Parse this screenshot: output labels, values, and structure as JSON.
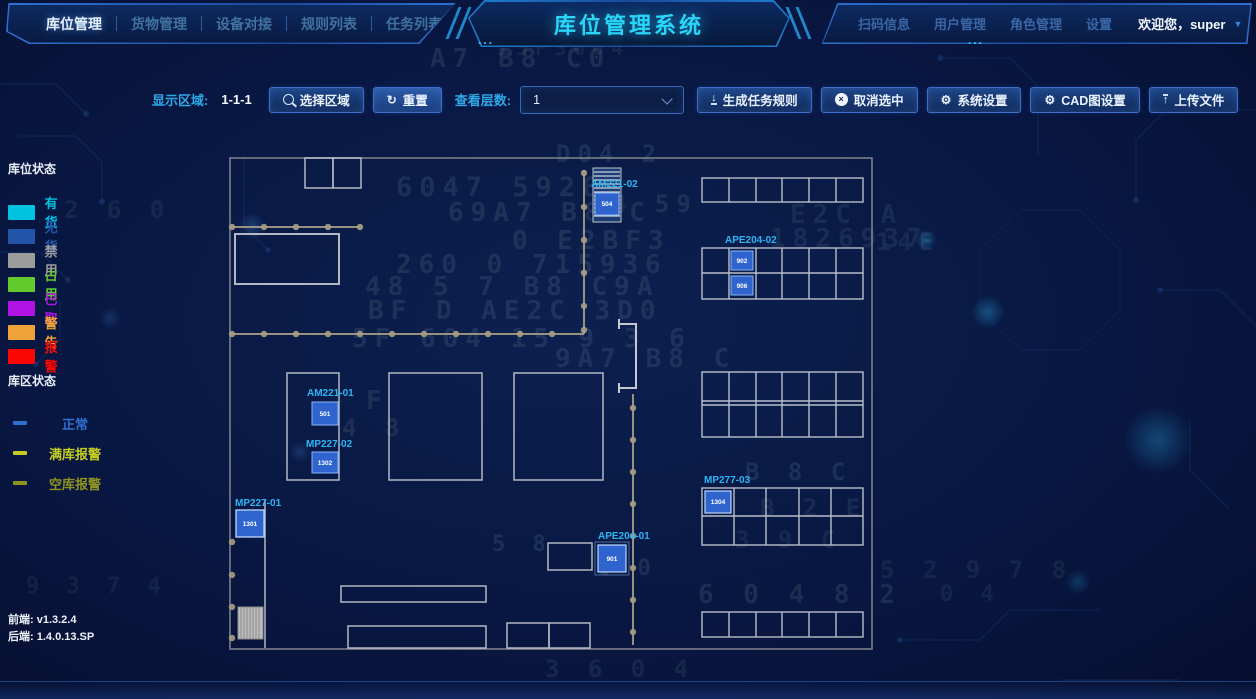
{
  "header": {
    "title": "库位管理系统",
    "dots": "...",
    "left_nav": [
      {
        "label": "库位管理"
      },
      {
        "label": "货物管理"
      },
      {
        "label": "设备对接"
      },
      {
        "label": "规则列表"
      },
      {
        "label": "任务列表"
      }
    ],
    "right_nav": [
      {
        "label": "扫码信息"
      },
      {
        "label": "用户管理"
      },
      {
        "label": "角色管理"
      },
      {
        "label": "设置"
      }
    ],
    "welcome": "欢迎您，super"
  },
  "toolbar": {
    "display_area_label": "显示区域:",
    "display_area_value": "1-1-1",
    "select_area_button": "选择区域",
    "reset_button": "重置",
    "view_layers_label": "查看层数:",
    "view_layers_value": "1",
    "generate_task_rule_button": "生成任务规则",
    "cancel_selection_button": "取消选中",
    "system_settings_button": "系统设置",
    "cad_settings_button": "CAD图设置",
    "upload_file_button": "上传文件"
  },
  "legend": {
    "slot_status_title": "库位状态",
    "slot_statuses": [
      {
        "label": "有货",
        "color": "#00c3e0"
      },
      {
        "label": "无货",
        "color": "#2255a8"
      },
      {
        "label": "禁用",
        "color": "#9c9c9c"
      },
      {
        "label": "占用",
        "color": "#63ca2d"
      },
      {
        "label": "已取",
        "color": "#b013e4"
      },
      {
        "label": "警告",
        "color": "#eda338"
      },
      {
        "label": "报警",
        "color": "#fa0703"
      }
    ],
    "zone_status_title": "库区状态",
    "zone_statuses": [
      {
        "label": "正常",
        "color": "#2e6fd2"
      },
      {
        "label": "满库报警",
        "color": "#c4cd22"
      },
      {
        "label": "空库报警",
        "color": "#8f941f"
      }
    ]
  },
  "versions": {
    "frontend": "前端: v1.3.2.4",
    "backend": "后端: 1.4.0.13.SP"
  },
  "floor_plan": {
    "locations": {
      "am221_02": {
        "name": "AM221-02",
        "slot": "504"
      },
      "ape204_02": {
        "name": "APE204-02",
        "slot_top": "902",
        "slot_bottom": "906"
      },
      "am221_01": {
        "name": "AM221-01",
        "slot": "501"
      },
      "mp227_02": {
        "name": "MP227-02",
        "slot": "1302"
      },
      "mp227_01": {
        "name": "MP227-01",
        "slot": "1301"
      },
      "ape204_01": {
        "name": "APE204-01",
        "slot": "901"
      },
      "mp277_03": {
        "name": "MP277-03",
        "slot": "1304"
      }
    }
  },
  "background_hex": [
    {
      "text": "A7 B8 C0",
      "x": 430,
      "y": 44,
      "s": 26
    },
    {
      "text": "15F3604",
      "x": 497,
      "y": 36,
      "s": 20,
      "o": 0.09
    },
    {
      "text": "D04 2",
      "x": 556,
      "y": 140,
      "s": 24
    },
    {
      "text": "6047 5926",
      "x": 396,
      "y": 172,
      "s": 27
    },
    {
      "text": "4 59",
      "x": 612,
      "y": 190,
      "s": 24
    },
    {
      "text": "69A7 B8 C",
      "x": 448,
      "y": 198,
      "s": 26
    },
    {
      "text": "E2C A",
      "x": 790,
      "y": 200,
      "s": 26,
      "o": 0.1
    },
    {
      "text": "0 E2BF3",
      "x": 512,
      "y": 226,
      "s": 26
    },
    {
      "text": "14E",
      "x": 876,
      "y": 228,
      "s": 24,
      "o": 0.1
    },
    {
      "text": "1826937",
      "x": 770,
      "y": 224,
      "s": 26,
      "o": 0.1
    },
    {
      "text": "260 0 715936",
      "x": 396,
      "y": 250,
      "s": 26
    },
    {
      "text": "48 5 7 B8 C9A",
      "x": 365,
      "y": 272,
      "s": 26
    },
    {
      "text": "BF D AE2C 3D0",
      "x": 368,
      "y": 296,
      "s": 26
    },
    {
      "text": "5F 604 15 9 3 6",
      "x": 352,
      "y": 324,
      "s": 26
    },
    {
      "text": "9A7 B8 C",
      "x": 555,
      "y": 344,
      "s": 26
    },
    {
      "text": "F",
      "x": 366,
      "y": 386,
      "s": 26
    },
    {
      "text": "4 8",
      "x": 342,
      "y": 414,
      "s": 24
    },
    {
      "text": "B 8 C",
      "x": 745,
      "y": 458,
      "s": 24
    },
    {
      "text": "B 2 E",
      "x": 760,
      "y": 494,
      "s": 24,
      "o": 0.1
    },
    {
      "text": "3 9 C",
      "x": 735,
      "y": 526,
      "s": 24,
      "o": 0.09
    },
    {
      "text": "5 8",
      "x": 492,
      "y": 532,
      "s": 22
    },
    {
      "text": "C 0",
      "x": 597,
      "y": 556,
      "s": 22
    },
    {
      "text": "6 0 4 8 2",
      "x": 698,
      "y": 580,
      "s": 26
    },
    {
      "text": "5 2 9 7 8",
      "x": 880,
      "y": 556,
      "s": 24,
      "o": 0.09
    },
    {
      "text": "0 4",
      "x": 940,
      "y": 582,
      "s": 22,
      "o": 0.09
    },
    {
      "text": "3 6 0 4",
      "x": 545,
      "y": 655,
      "s": 24,
      "o": 0.1
    },
    {
      "text": "2 6 0",
      "x": 64,
      "y": 196,
      "s": 24,
      "o": 0.09
    },
    {
      "text": "9 3 7 4",
      "x": 26,
      "y": 574,
      "s": 22,
      "o": 0.08
    }
  ]
}
